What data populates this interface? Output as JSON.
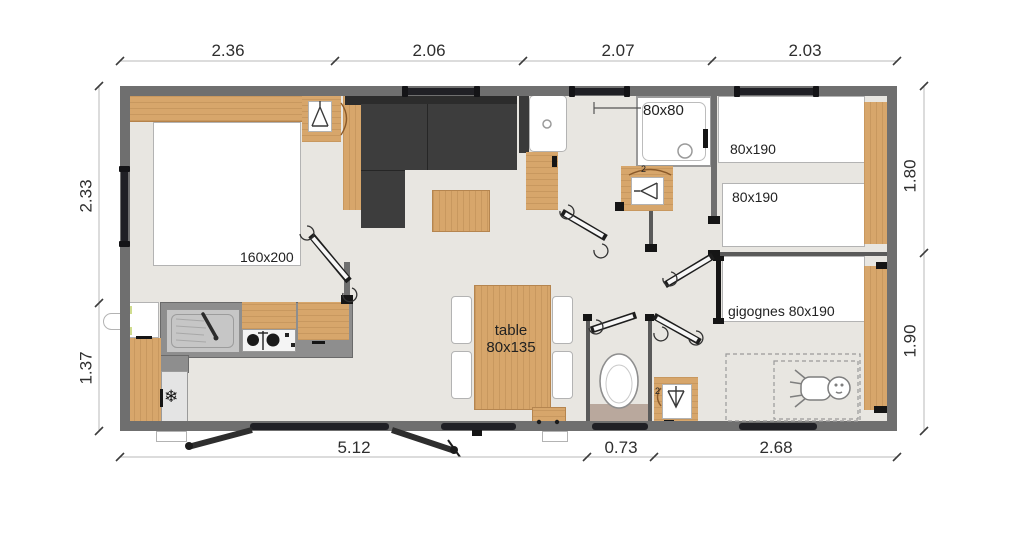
{
  "plan": {
    "dimensions_top": [
      "2.36",
      "2.06",
      "2.07",
      "2.03"
    ],
    "dimensions_left": [
      "2.33",
      "1.37"
    ],
    "dimensions_right": [
      "1.80",
      "1.90"
    ],
    "dimensions_bottom": [
      "5.12",
      "0.73",
      "2.68"
    ],
    "room_labels": {
      "master_bed": "160x200",
      "shower": "80x80",
      "kids_bed_1": "80x190",
      "kids_bed_2": "80x190",
      "trundle_beds": "gigognes 80x190",
      "dining_table_line1": "table",
      "dining_table_line2": "80x135",
      "wardrobe_count": "2"
    },
    "icons": {
      "snowflake": "❄"
    },
    "colors": {
      "wall": "#6f6f6f",
      "floor": "#e8e6e1",
      "wood": "#d7a66b",
      "sofa": "#3d3d3d",
      "counter": "#8e8e8e",
      "window": "#202025",
      "wc_mat": "#b9a89d"
    }
  }
}
